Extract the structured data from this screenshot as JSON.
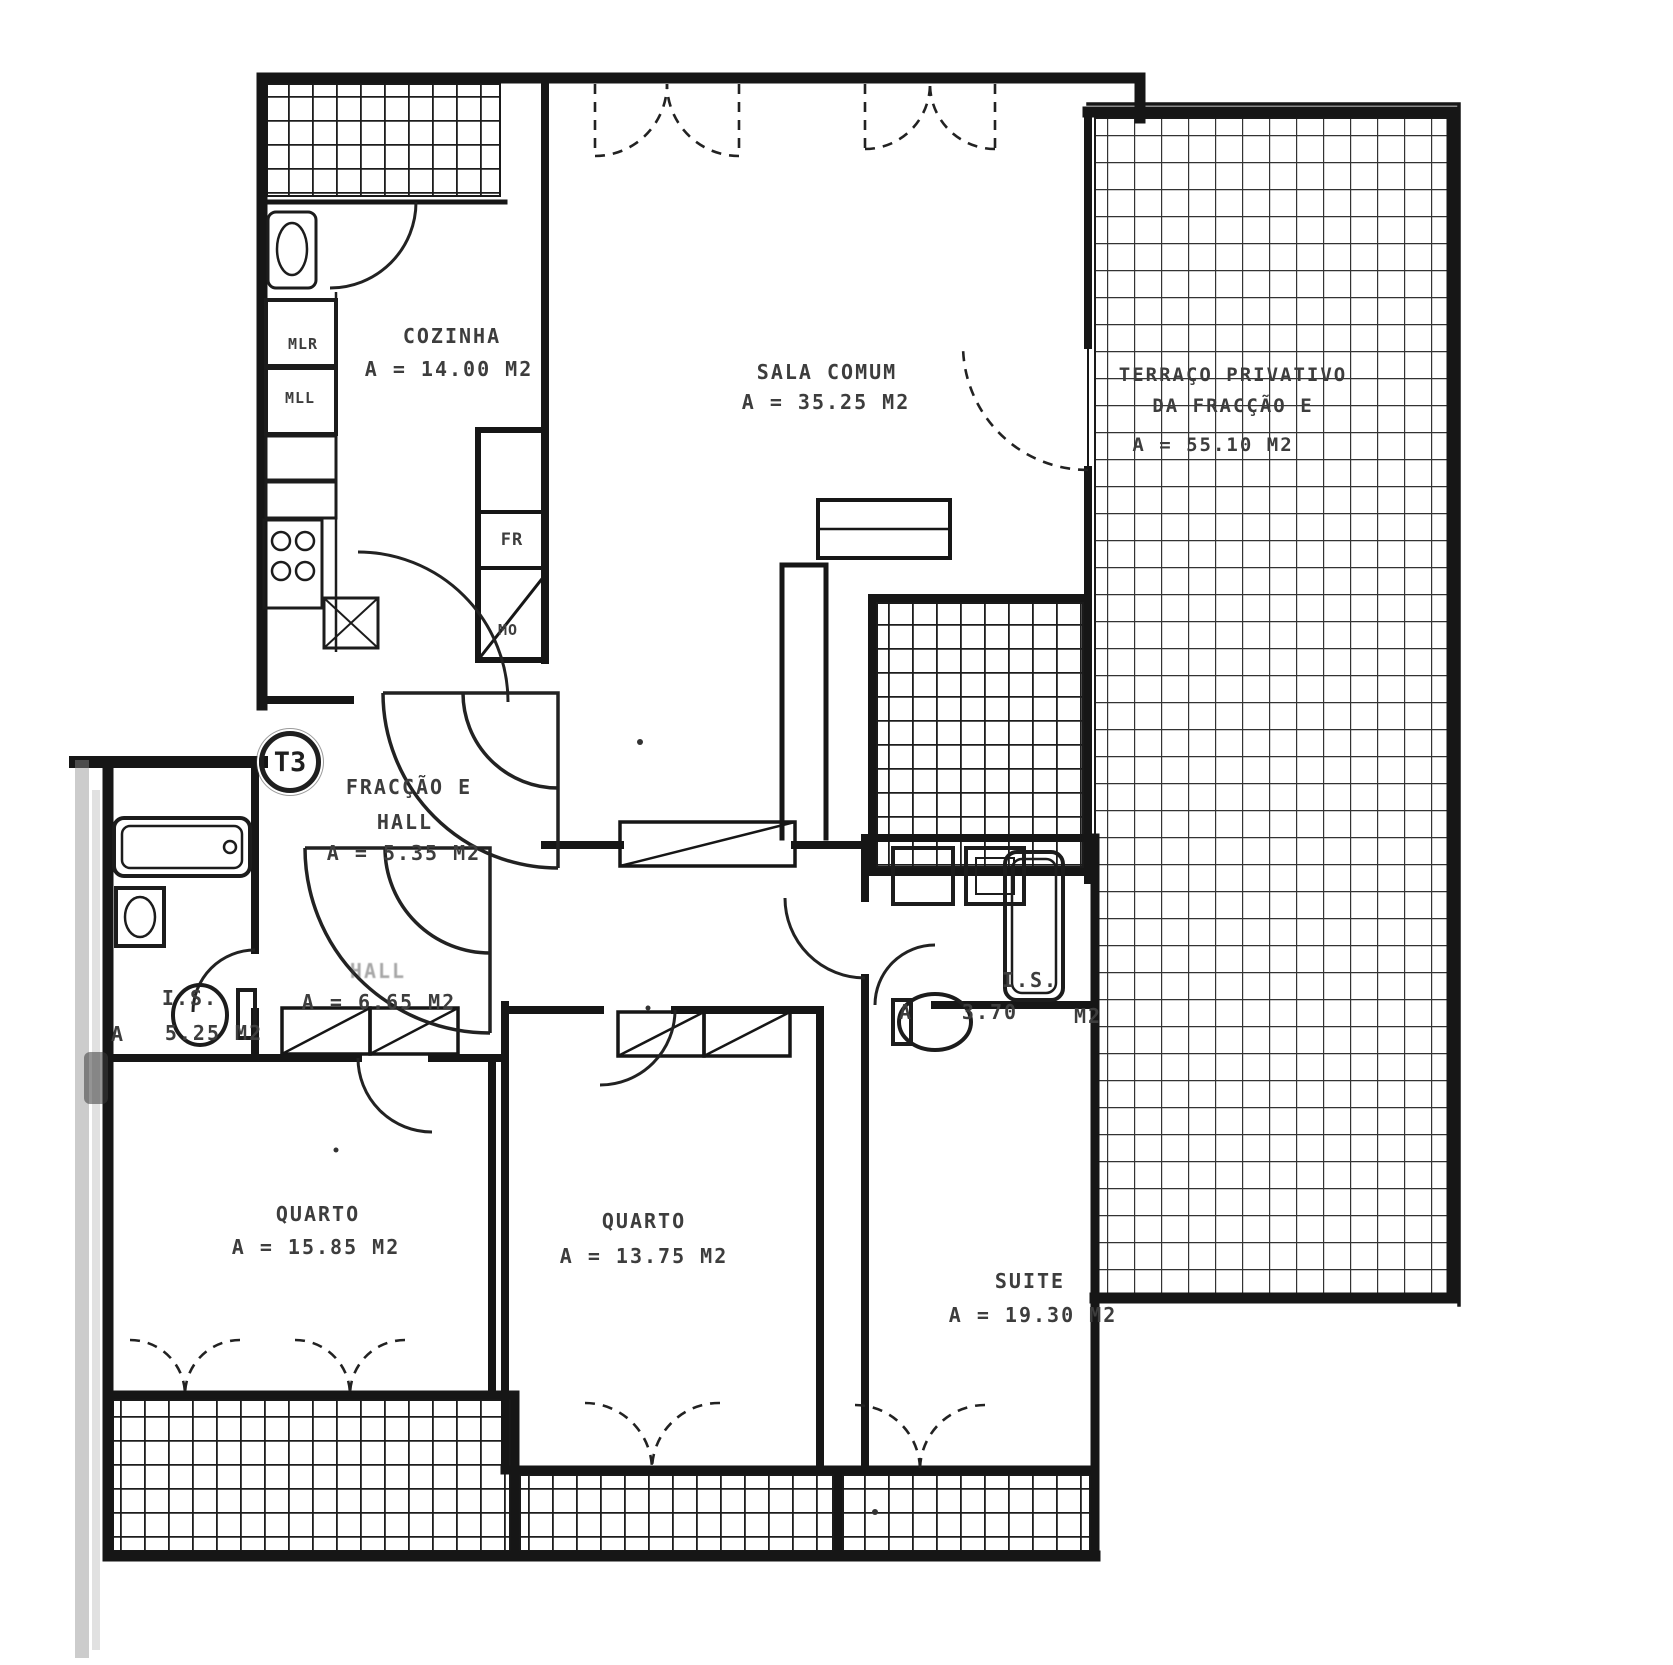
{
  "document": {
    "type_label": "T3"
  },
  "colors": {
    "ink": "#1c1c1c",
    "label": "#3d3d3d",
    "paper": "#ffffff"
  },
  "rooms": {
    "cozinha": {
      "name": "COZINHA",
      "area": "A = 14.00 M2"
    },
    "sala": {
      "name": "SALA COMUM",
      "area": "A = 35.25 M2"
    },
    "terraco": {
      "name_line1": "TERRAÇO PRIVATIVO",
      "name_line2": "DA FRACÇÃO E",
      "area": "A = 55.10 M2"
    },
    "entry_hall": {
      "name_line1": "FRACÇÃO E",
      "name_line2": "HALL",
      "area": "A = 5.35 M2"
    },
    "hall": {
      "name": "HALL",
      "area": "A = 6.65 M2"
    },
    "is_left": {
      "name": "I.S.",
      "area_prefix": "A",
      "area": "5.25 M2"
    },
    "is_suite": {
      "name": "I.S.",
      "area_prefix": "A",
      "area": "3.70",
      "area_unit": "M2"
    },
    "quarto_1": {
      "name": "QUARTO",
      "area": "A = 15.85 M2"
    },
    "quarto_2": {
      "name": "QUARTO",
      "area": "A = 13.75 M2"
    },
    "suite": {
      "name": "SUITE",
      "area": "A = 19.30 M2"
    }
  },
  "appliances": {
    "mlr": "MLR",
    "mll": "MLL",
    "fr": "FR",
    "mo": "MO"
  }
}
